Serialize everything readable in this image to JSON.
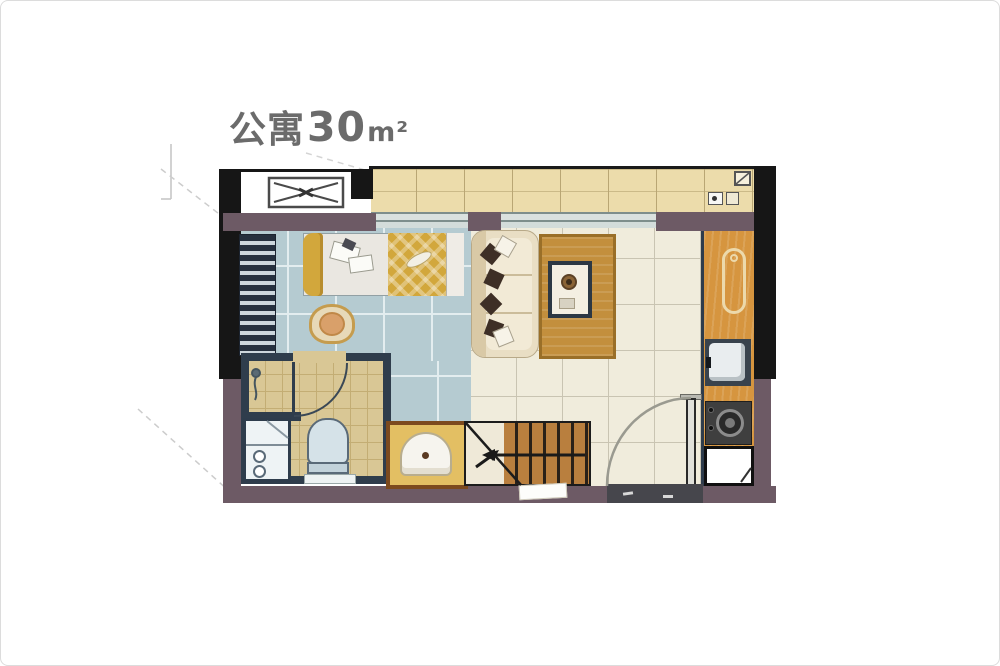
{
  "title": {
    "text": "公寓30m²",
    "prefix": "公寓",
    "area": "30",
    "unit": "m²"
  },
  "floorplan": {
    "kind": "studio-apartment-floor-plan",
    "area_sqm_shown": "30",
    "fixtures": [
      "ac-outdoor-unit",
      "balcony",
      "sliding-window",
      "wardrobe",
      "double-bed",
      "armchair",
      "sofa",
      "area-rug",
      "coffee-table",
      "kitchen-counter",
      "cutting-board",
      "kitchen-sink",
      "cooktop",
      "refrigerator",
      "washing-machine",
      "toilet",
      "shower",
      "bathroom-door",
      "washbasin",
      "staircase",
      "stairs-direction-arrow",
      "entry-door",
      "door-mat"
    ],
    "colors": {
      "card-border": "#dcdcdc",
      "title-text": "#6b6b6b",
      "wall-black": "#161616",
      "wall-mauve": "#6d5a65",
      "wall-navy": "#2f3d4c",
      "balcony-tile": "#ecdcab",
      "bedroom-floor": "#b5cbd1",
      "living-floor": "#f0ecdc",
      "bath-floor": "#d9c795",
      "kitchen-wood": "#d6953f",
      "stairs-wood": "#b97f3e",
      "rug-wood": "#c38f3d",
      "blanket-gold": "#d2a73c",
      "sofa-cream": "#e9dec4",
      "cushion-brown": "#3e2f26",
      "basin-counter": "#e3bf63",
      "basin-border": "#7c4a1e",
      "mat-gray": "#46464c",
      "leader-line": "#cccccc"
    }
  }
}
